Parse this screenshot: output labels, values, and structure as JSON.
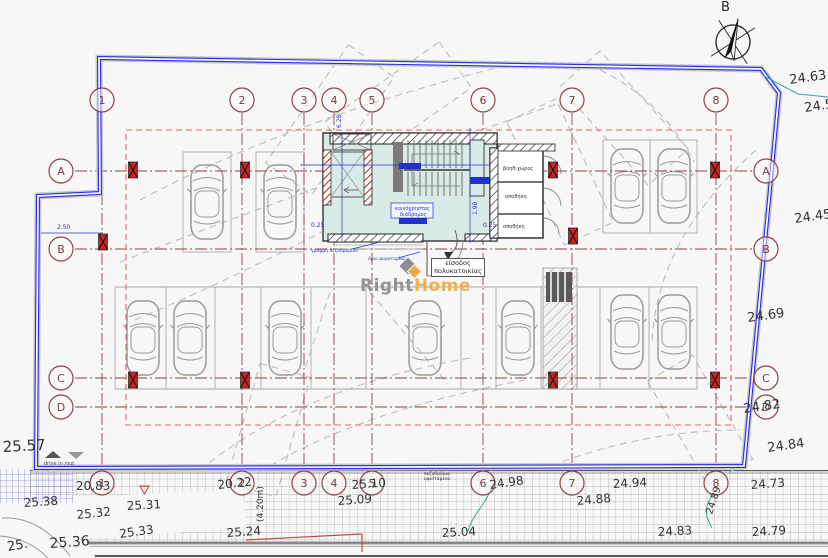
{
  "compass": {
    "label": "B"
  },
  "logo": {
    "part1": "Right",
    "part2": "Home"
  },
  "entrance_label": {
    "line1": "είσοδος",
    "line2": "πολυκατοικίας"
  },
  "colors": {
    "boundary": "#2a2ae0",
    "grid_axis": "#8a4545",
    "overhang_dashed": "#e06666",
    "annotation_blue": "#2233cc",
    "leader_teal": "#3aa79a",
    "core_fill": "#d9ebe6",
    "column_red": "#cc2222",
    "logo_orange": "#e9aa45",
    "logo_gray": "#949494"
  },
  "grid": {
    "radius": 12,
    "top_bubble_y": 100,
    "bottom_bubble_y": 483,
    "left_bubble_x": 61,
    "right_bubble_x": 766,
    "columns": [
      {
        "label": "1",
        "x": 102
      },
      {
        "label": "2",
        "x": 242
      },
      {
        "label": "3",
        "x": 304
      },
      {
        "label": "4",
        "x": 334
      },
      {
        "label": "5",
        "x": 372
      },
      {
        "label": "6",
        "x": 483
      },
      {
        "label": "7",
        "x": 572
      },
      {
        "label": "8",
        "x": 716
      }
    ],
    "rows": [
      {
        "label": "A",
        "y": 171
      },
      {
        "label": "B",
        "y": 249
      },
      {
        "label": "C",
        "y": 378
      },
      {
        "label": "D",
        "y": 407
      }
    ]
  },
  "cars": [
    {
      "x": 207,
      "y": 202
    },
    {
      "x": 280,
      "y": 202
    },
    {
      "x": 627,
      "y": 186
    },
    {
      "x": 674,
      "y": 186
    },
    {
      "x": 627,
      "y": 332
    },
    {
      "x": 674,
      "y": 332
    },
    {
      "x": 143,
      "y": 338
    },
    {
      "x": 190,
      "y": 338
    },
    {
      "x": 285,
      "y": 338
    },
    {
      "x": 425,
      "y": 338
    },
    {
      "x": 518,
      "y": 338
    }
  ],
  "column_markers": [
    {
      "x": 133,
      "y": 170
    },
    {
      "x": 245,
      "y": 170
    },
    {
      "x": 553,
      "y": 170
    },
    {
      "x": 715,
      "y": 170
    },
    {
      "x": 103,
      "y": 242
    },
    {
      "x": 573,
      "y": 236
    },
    {
      "x": 133,
      "y": 380
    },
    {
      "x": 245,
      "y": 380
    },
    {
      "x": 553,
      "y": 380
    },
    {
      "x": 715,
      "y": 380
    }
  ],
  "labels": [
    {
      "n": "spot-elevation",
      "t": "25.57",
      "x": 3,
      "y": 452,
      "s": 15,
      "r": -3
    },
    {
      "n": "spot-elevation",
      "t": "20.83",
      "x": 76,
      "y": 490,
      "s": 12,
      "r": 0
    },
    {
      "n": "spot-elevation",
      "t": "20.22",
      "x": 218,
      "y": 489,
      "s": 12,
      "r": -6
    },
    {
      "n": "spot-elevation",
      "t": "25.10",
      "x": 352,
      "y": 489,
      "s": 12,
      "r": -4
    },
    {
      "n": "spot-elevation",
      "t": "25.09",
      "x": 338,
      "y": 505,
      "s": 12,
      "r": -4
    },
    {
      "n": "spot-elevation",
      "t": "24.98",
      "x": 490,
      "y": 489,
      "s": 12,
      "r": -8
    },
    {
      "n": "spot-elevation",
      "t": "25.04",
      "x": 442,
      "y": 537,
      "s": 12,
      "r": -3
    },
    {
      "n": "spot-elevation",
      "t": "24.94",
      "x": 613,
      "y": 488,
      "s": 12,
      "r": -3
    },
    {
      "n": "spot-elevation",
      "t": "24.88",
      "x": 577,
      "y": 505,
      "s": 12,
      "r": -5
    },
    {
      "n": "spot-elevation",
      "t": "24.73",
      "x": 751,
      "y": 489,
      "s": 12,
      "r": -4
    },
    {
      "n": "spot-elevation",
      "t": "24.83",
      "x": 658,
      "y": 536,
      "s": 12,
      "r": -3
    },
    {
      "n": "spot-elevation",
      "t": "24.79",
      "x": 752,
      "y": 536,
      "s": 12,
      "r": -3
    },
    {
      "n": "spot-elevation",
      "t": "25.38",
      "x": 24,
      "y": 507,
      "s": 12,
      "r": -4
    },
    {
      "n": "spot-elevation",
      "t": "25.32",
      "x": 77,
      "y": 519,
      "s": 12,
      "r": -6
    },
    {
      "n": "spot-elevation",
      "t": "25.31",
      "x": 127,
      "y": 510,
      "s": 12,
      "r": -3
    },
    {
      "n": "spot-elevation",
      "t": "25.33",
      "x": 120,
      "y": 538,
      "s": 12,
      "r": -8
    },
    {
      "n": "spot-elevation",
      "t": "25.24",
      "x": 227,
      "y": 537,
      "s": 12,
      "r": -4
    },
    {
      "n": "spot-elevation",
      "t": "25.36",
      "x": 50,
      "y": 548,
      "s": 14,
      "r": -4
    },
    {
      "n": "spot-elevation",
      "t": "25.",
      "x": 8,
      "y": 551,
      "s": 13,
      "r": -10
    },
    {
      "n": "dim-sidewalk-width",
      "t": "(4.20m)",
      "x": 263,
      "y": 522,
      "s": 9,
      "r": -90
    },
    {
      "n": "boundary-elevation",
      "t": "24.63",
      "x": 790,
      "y": 84,
      "s": 13,
      "r": -8
    },
    {
      "n": "boundary-elevation",
      "t": "24.5",
      "x": 805,
      "y": 112,
      "s": 13,
      "r": -8
    },
    {
      "n": "boundary-elevation",
      "t": "24.45",
      "x": 795,
      "y": 223,
      "s": 13,
      "r": -8
    },
    {
      "n": "boundary-elevation",
      "t": "24.69",
      "x": 748,
      "y": 322,
      "s": 13,
      "r": -8
    },
    {
      "n": "boundary-elevation",
      "t": "24.82",
      "x": 744,
      "y": 413,
      "s": 13,
      "r": -8
    },
    {
      "n": "boundary-elevation",
      "t": "24.84",
      "x": 768,
      "y": 452,
      "s": 13,
      "r": -8
    },
    {
      "n": "boundary-elevation",
      "t": "24.89",
      "x": 712,
      "y": 515,
      "s": 10,
      "r": -72
    },
    {
      "n": "dim-blue",
      "t": "2.50",
      "x": 57,
      "y": 229,
      "s": 6,
      "c": "#2233cc"
    },
    {
      "n": "dim-blue",
      "t": "6.28",
      "x": 341,
      "y": 128,
      "s": 6,
      "c": "#2233cc",
      "r": -90
    },
    {
      "n": "dim-blue",
      "t": "1.98",
      "x": 477,
      "y": 215,
      "s": 6,
      "c": "#2233cc",
      "r": -90
    },
    {
      "n": "dim-blue",
      "t": "0.25",
      "x": 311,
      "y": 227,
      "s": 6,
      "c": "#2233cc"
    },
    {
      "n": "dim-blue",
      "t": "0.25",
      "x": 483,
      "y": 227,
      "s": 6,
      "c": "#2233cc"
    },
    {
      "n": "room-label",
      "t": "βοηθ.χώρος",
      "x": 503,
      "y": 170,
      "s": 5
    },
    {
      "n": "room-label",
      "t": "αποθήκη",
      "x": 505,
      "y": 198,
      "s": 5
    },
    {
      "n": "room-label",
      "t": "αποθήκη",
      "x": 503,
      "y": 228,
      "s": 5
    },
    {
      "n": "corridor-label",
      "t": "κοινόχρηστος",
      "x": 395,
      "y": 210,
      "s": 5,
      "c": "#2233cc"
    },
    {
      "n": "corridor-label",
      "t": "διάδρομος",
      "x": 400,
      "y": 216,
      "s": 5,
      "c": "#2233cc"
    },
    {
      "n": "annotation-tag",
      "t": "γραμμή πεζοδρομίου",
      "x": 311,
      "y": 252,
      "s": 4.5,
      "c": "#2233cc"
    },
    {
      "n": "annotation-tag",
      "t": "όριο ρυμοτομίας",
      "x": 368,
      "y": 260,
      "s": 4.5,
      "c": "#2233cc"
    },
    {
      "n": "driveway-caption",
      "t": "drive in /out",
      "x": 44,
      "y": 465,
      "s": 5,
      "c": "#444"
    },
    {
      "n": "sidewalk-note",
      "t": "πεζοδρόμιο",
      "x": 424,
      "y": 475,
      "s": 4.5
    },
    {
      "n": "sidewalk-note",
      "t": "υφιστάμενο",
      "x": 424,
      "y": 480,
      "s": 4.5
    }
  ]
}
